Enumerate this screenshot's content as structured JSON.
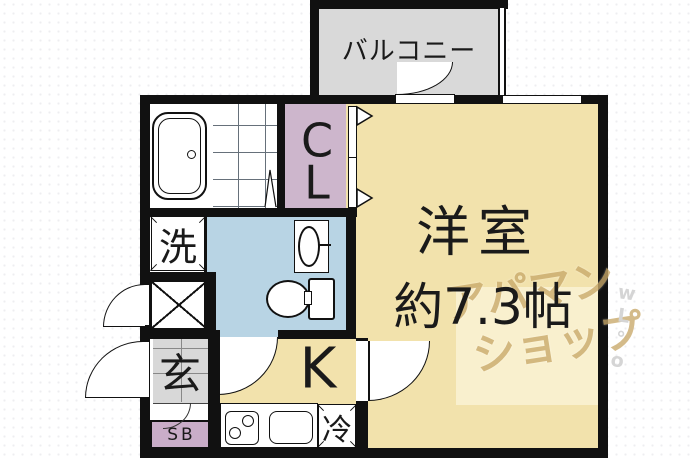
{
  "rooms": {
    "balcony": {
      "label": "バルコニー"
    },
    "closet": {
      "line1": "C",
      "line2": "L"
    },
    "western_room": {
      "name": "洋室",
      "size": "約7.3帖"
    },
    "kitchen": {
      "label": "K"
    },
    "entrance": {
      "label": "玄"
    },
    "shoe_box": {
      "label": "SB"
    },
    "washer_space": {
      "label": "洗"
    },
    "refrigerator_space": {
      "label": "冷"
    }
  },
  "watermark": {
    "line1": "アパマン",
    "line2": "ショップ",
    "side_marks": [
      "w",
      "L",
      "°",
      "o"
    ]
  },
  "colors": {
    "wall": "#111111",
    "room_floor": "#f2e2ac",
    "washroom_floor": "#b8d4e4",
    "closet": "#cdb6cc",
    "balcony": "#d9d9d9",
    "entrance_floor": "#d8d8d8",
    "shoe_box": "#c9adc8",
    "watermark_text": "#c9a96a"
  }
}
